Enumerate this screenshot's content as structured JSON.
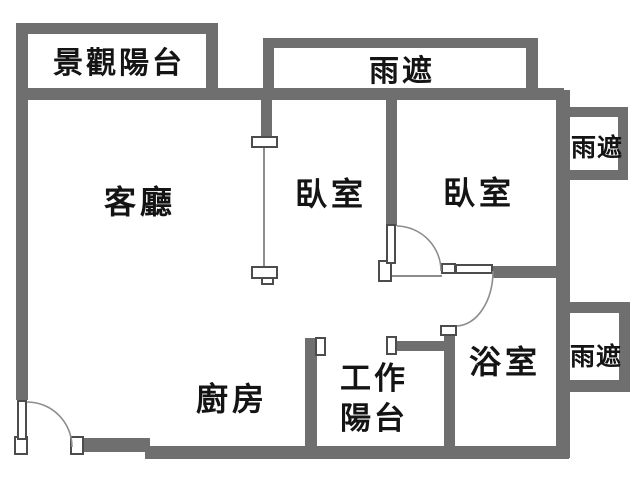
{
  "floorplan": {
    "title": "apartment-floor-plan",
    "rooms": {
      "view_balcony": "景觀陽台",
      "rain_canopy_top": "雨遮",
      "rain_canopy_right_upper": "雨遮",
      "rain_canopy_right_lower": "雨遮",
      "living_room": "客廳",
      "bedroom_left": "臥室",
      "bedroom_right": "臥室",
      "bathroom": "浴室",
      "kitchen": "廚房",
      "work_balcony_line1": "工作",
      "work_balcony_line2": "陽台"
    },
    "colors": {
      "wall": "#6f6f6f",
      "thin_line": "#8d8d8d",
      "text": "#141414",
      "background": "#ffffff"
    }
  }
}
